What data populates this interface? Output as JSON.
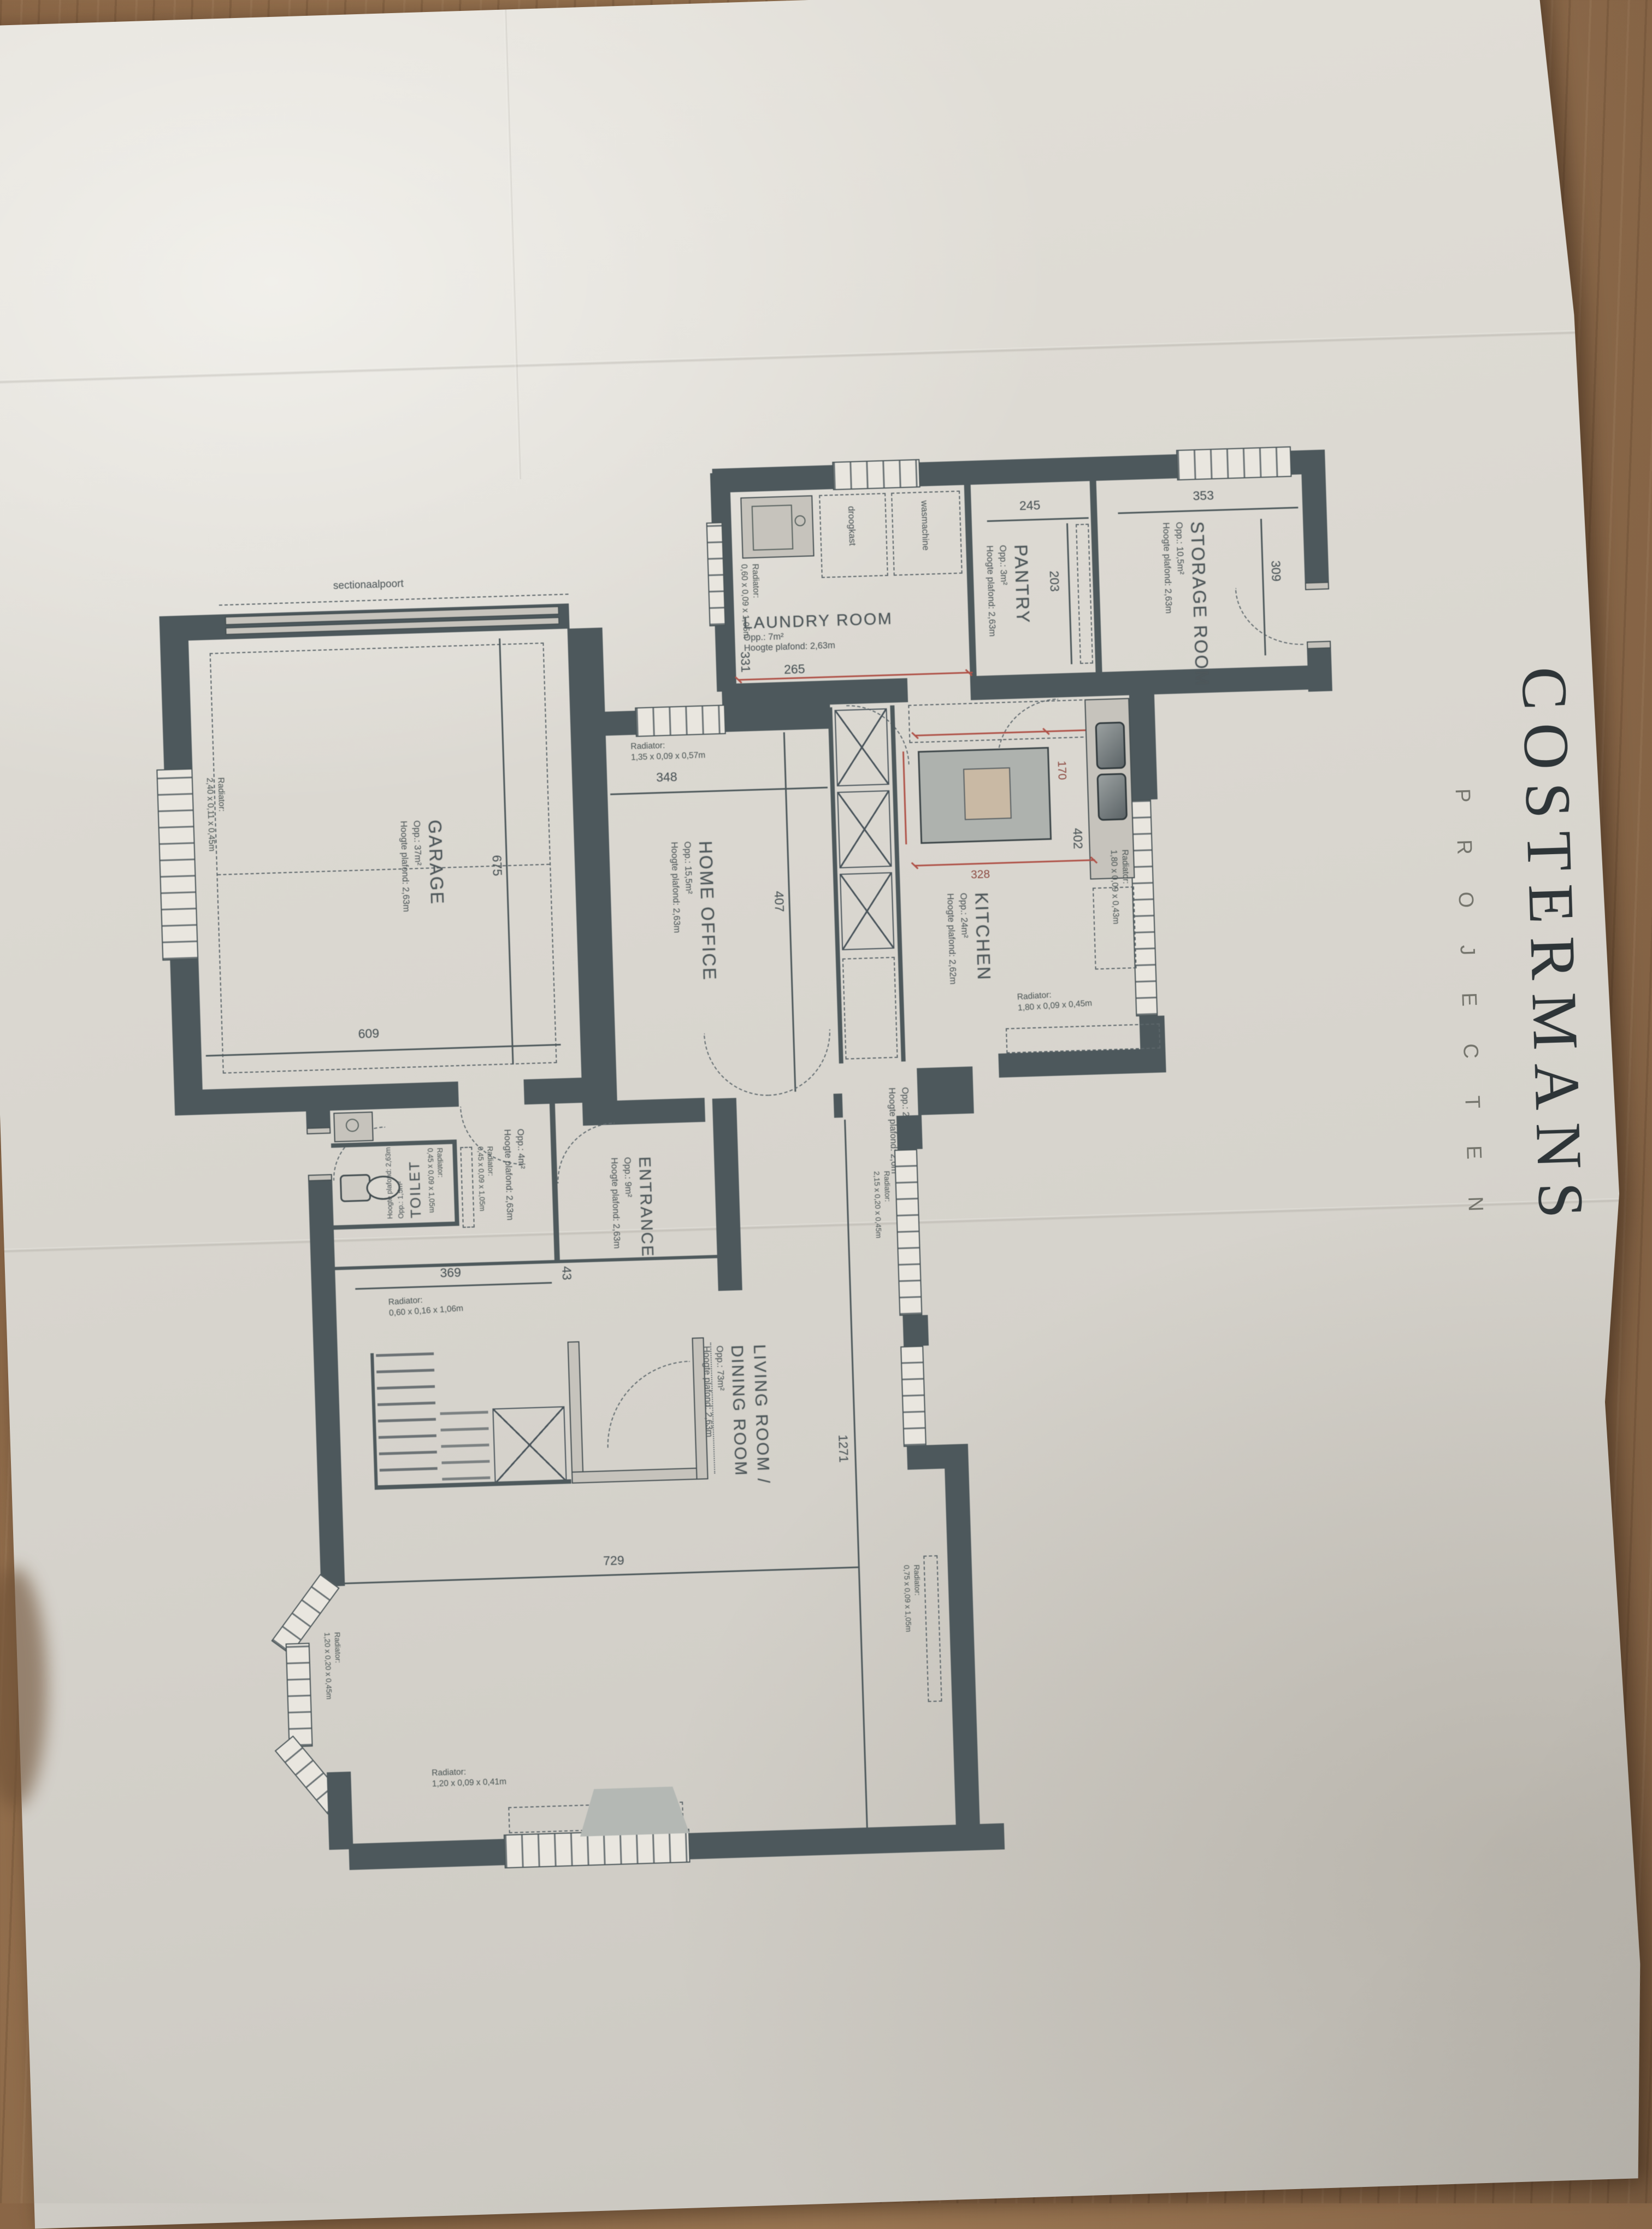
{
  "brand": {
    "name": "COSTERMANS",
    "sub": "PROJECTEN"
  },
  "rooms": {
    "storage": {
      "name": "STORAGE ROOM",
      "area": "Opp.: 10,5m²",
      "ceiling": "Hoogte plafond: 2,63m",
      "dim_top": "353",
      "dim_side": "309"
    },
    "laundry": {
      "name": "LAUNDRY ROOM",
      "area": "Opp.: 7m²",
      "ceiling": "Hoogte plafond: 2,63m",
      "dim_side": "331",
      "dim_bottom": "265",
      "appliance_dryer": "droogkast",
      "appliance_washer": "wasmachine",
      "radiator": "Radiator:\n0,60 x 0,09 x 1,05m"
    },
    "pantry": {
      "name": "PANTRY",
      "area": "Opp.: 3m²",
      "ceiling": "Hoogte plafond: 2,63m",
      "dim_top": "245",
      "dim_side": "203"
    },
    "kitchen": {
      "name": "KITCHEN",
      "area": "Opp.: 24m²",
      "ceiling": "Hoogte plafond: 2,62m",
      "dim_island": "328",
      "dim_side": "402",
      "dim_red": "170",
      "radiator_wall": "Radiator:\n1,80 x 0,09 x 0,43m",
      "radiator_bottom": "Radiator:\n1,80 x 0,09 x 0,45m"
    },
    "home_office": {
      "name": "HOME OFFICE",
      "area": "Opp.: 15,5m²",
      "ceiling": "Hoogte plafond: 2,63m",
      "dim_top": "348",
      "dim_side": "407",
      "radiator": "Radiator:\n1,35 x 0,09 x 0,57m"
    },
    "garage": {
      "name": "GARAGE",
      "area": "Opp.: 37m²",
      "ceiling": "Hoogte plafond: 2,63m",
      "dim_bottom": "609",
      "dim_side": "675",
      "door_label": "sectionaalpoort",
      "radiator": "Radiator:\n2,40 x 0,11 x 0,45m"
    },
    "toilet": {
      "name": "TOILET",
      "area": "Opp.: 1,5m²",
      "ceiling": "Hoogte plafond: 2,63m",
      "radiator": "Radiator:\n0,45 x 0,09 x 1,05m"
    },
    "hall": {
      "area": "Opp.: 4m²",
      "ceiling": "Hoogte plafond: 2,63m",
      "dim_bottom": "369",
      "dim_side": "43",
      "radiator": "Radiator:\n0,45 x 0,09 x 1,05m",
      "radiator_low": "Radiator:\n0,60 x 0,16 x 1,06m"
    },
    "entrance": {
      "name": "ENTRANCE",
      "area": "Opp.: 9m²",
      "ceiling": "Hoogte plafond: 2,63m"
    },
    "corridor": {
      "area": "Opp.: 2,5m²",
      "ceiling": "Hoogte plafond: 2,6m"
    },
    "living": {
      "name_line1": "LIVING ROOM /",
      "name_line2": "DINING ROOM",
      "area": "Opp.: 73m²",
      "ceiling": "Hoogte plafond: 2,63m",
      "dim_bottom": "729",
      "dim_side": "1271",
      "radiator_window": "Radiator:\n2,15 x 0,20 x 0,45m",
      "radiator_right": "Radiator:\n0,75 x 0,09 x 1,05m",
      "radiator_bottom": "Radiator:\n1,20 x 0,09 x 0,41m",
      "radiator_bay": "Radiator:\n1,20 x 0,20 x 0,45m"
    }
  },
  "colors": {
    "wall": "#4d585c",
    "paper": "#d9d6cf",
    "wood": "#8f6c4c",
    "dimension_red": "#b0544a",
    "ink": "#4e575a"
  }
}
